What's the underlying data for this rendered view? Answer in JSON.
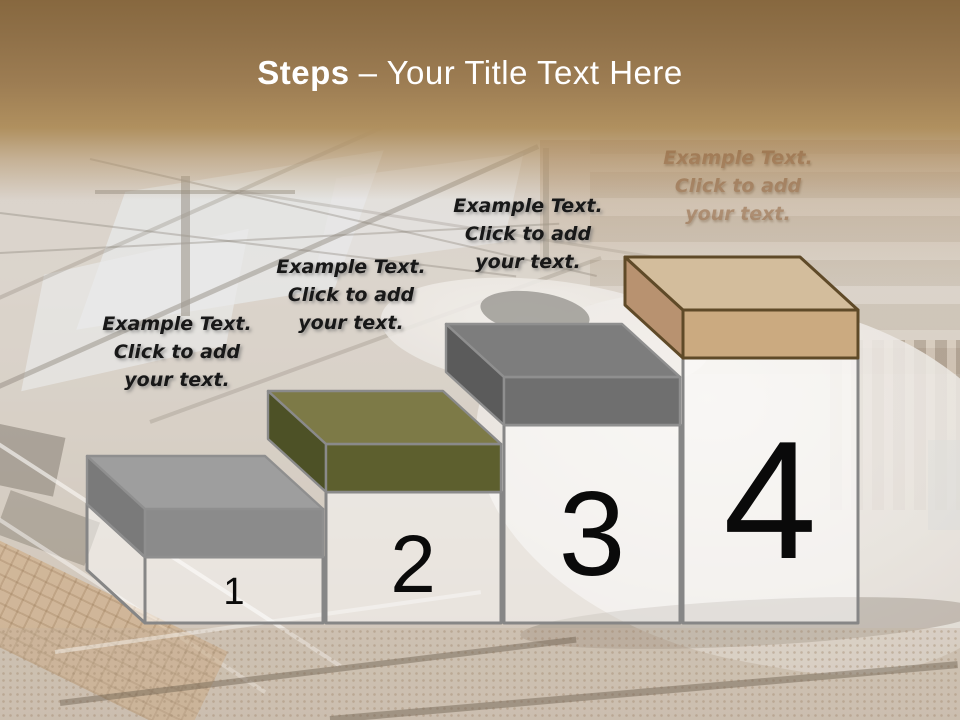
{
  "title": {
    "bold_text": "Steps",
    "regular_text": "– Your Title Text Here"
  },
  "steps": [
    {
      "number": "1",
      "label_lines": [
        "Example Text.",
        "Click  to add",
        "your text."
      ],
      "colors": {
        "top": "#9e9e9e",
        "front": "#8b8b8b",
        "side": "#7a7a7a",
        "border": "#8f8f8f"
      }
    },
    {
      "number": "2",
      "label_lines": [
        "Example Text.",
        "Click  to add",
        "your text."
      ],
      "colors": {
        "top": "#7d7a47",
        "front": "#5d5f2e",
        "side": "#4d5126",
        "border": "#8a8a8a"
      }
    },
    {
      "number": "3",
      "label_lines": [
        "Example Text.",
        "Click  to add",
        "your text."
      ],
      "colors": {
        "top": "#7d7d7d",
        "front": "#6f6f6f",
        "side": "#5b5b5b",
        "border": "#8f8f8f"
      }
    },
    {
      "number": "4",
      "label_lines": [
        "Example Text.",
        "Click  to add",
        "your text."
      ],
      "colors": {
        "top": "#d3bd9c",
        "front": "#cbaa80",
        "side": "#b89270",
        "border": "#5f4a28"
      }
    }
  ],
  "column": {
    "fill": "rgba(255,255,255,0.5)",
    "border": "#868686"
  },
  "background": {
    "top_band_color": "#8a6b45"
  }
}
